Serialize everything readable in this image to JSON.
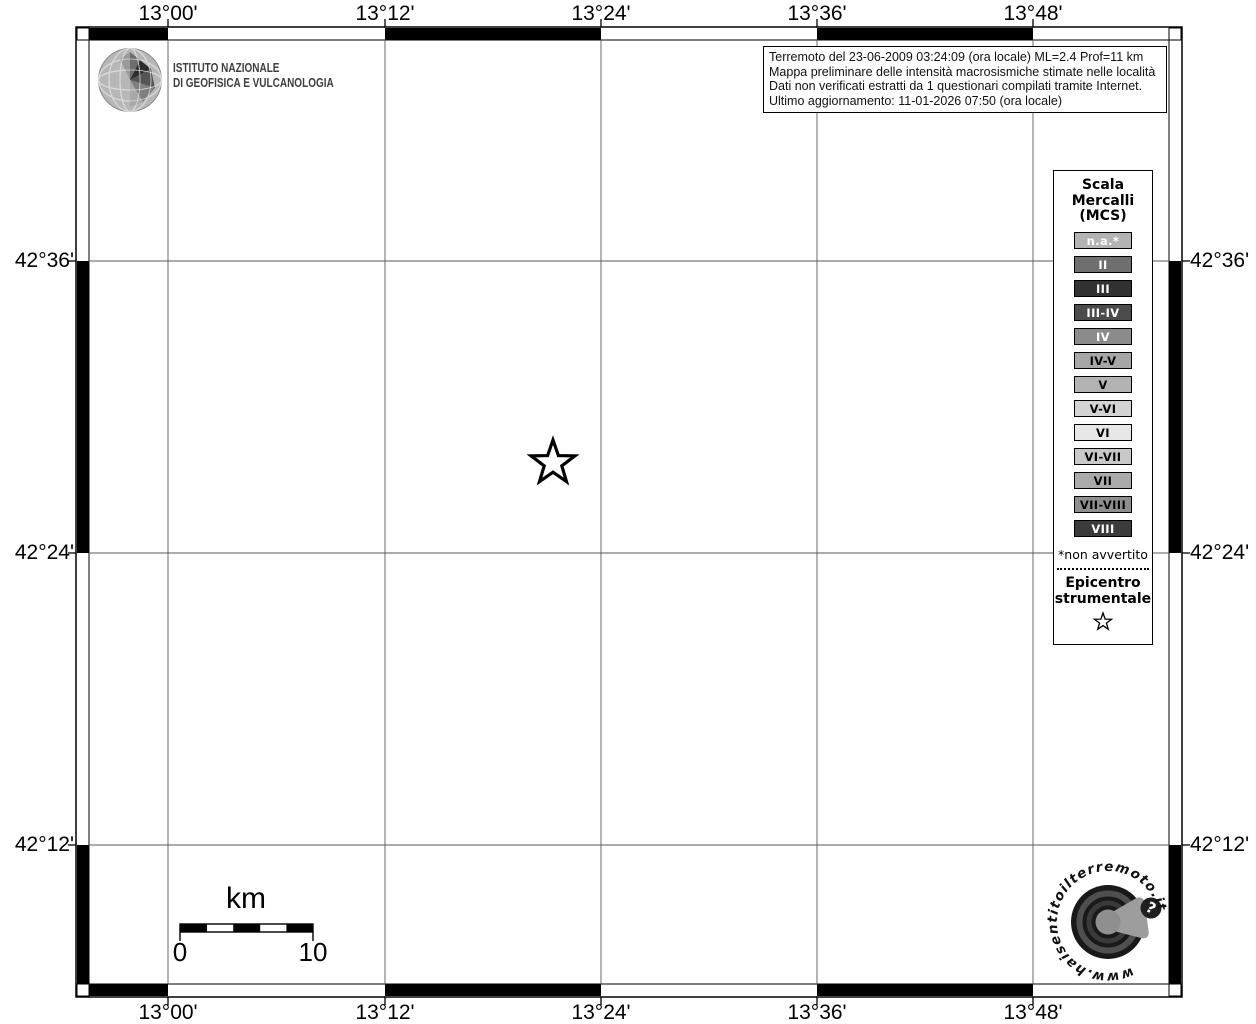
{
  "branding": {
    "ingv": {
      "name_line1": "ISTITUTO NAZIONALE",
      "name_line2": "DI GEOFISICA E VULCANOLOGIA"
    },
    "haisentito": {
      "ring_text": "www.haisentitoilterremoto.it",
      "badge": "?"
    }
  },
  "info_box": {
    "lines": [
      "Terremoto del 23-06-2009 03:24:09 (ora locale) ML=2.4 Prof=11 km",
      "Mappa preliminare delle intensità macrosismiche stimate nelle località",
      "Dati non verificati estratti da 1 questionari compilati tramite Internet.",
      "Ultimo aggiornamento: 11-01-2026 07:50 (ora locale)"
    ]
  },
  "map": {
    "top_labels": [
      "13°00'",
      "13°12'",
      "13°24'",
      "13°36'",
      "13°48'"
    ],
    "bottom_labels": [
      "13°00'",
      "13°12'",
      "13°24'",
      "13°36'",
      "13°48'"
    ],
    "left_labels": [
      "42°36'",
      "42°24'",
      "42°12'"
    ],
    "right_labels": [
      "42°36'",
      "42°24'",
      "42°12'"
    ],
    "epicenter_icon": "open-star"
  },
  "legend": {
    "title_lines": [
      "Scala",
      "Mercalli",
      "(MCS)"
    ],
    "items": [
      {
        "label": "n.a.*",
        "color": "#b3b3b3",
        "text": "#ffffff"
      },
      {
        "label": "II",
        "color": "#6f6f6f",
        "text": "#ffffff"
      },
      {
        "label": "III",
        "color": "#313131",
        "text": "#ffffff"
      },
      {
        "label": "III-IV",
        "color": "#4b4b4b",
        "text": "#ffffff"
      },
      {
        "label": "IV",
        "color": "#8b8b8b",
        "text": "#ffffff"
      },
      {
        "label": "IV-V",
        "color": "#a6a6a6",
        "text": "#000000"
      },
      {
        "label": "V",
        "color": "#b3b3b3",
        "text": "#000000"
      },
      {
        "label": "V-VI",
        "color": "#d3d3d3",
        "text": "#000000"
      },
      {
        "label": "VI",
        "color": "#e7e7e7",
        "text": "#000000"
      },
      {
        "label": "VI-VII",
        "color": "#c8c8c8",
        "text": "#000000"
      },
      {
        "label": "VII",
        "color": "#aaaaaa",
        "text": "#000000"
      },
      {
        "label": "VII-VIII",
        "color": "#8e8e8e",
        "text": "#000000"
      },
      {
        "label": "VIII",
        "color": "#3b3b3b",
        "text": "#ffffff"
      }
    ],
    "footnote": "*non avvertito",
    "epicenter_lines": [
      "Epicentro",
      "strumentale"
    ]
  },
  "scale_bar": {
    "unit": "km",
    "min": "0",
    "max": "10"
  }
}
